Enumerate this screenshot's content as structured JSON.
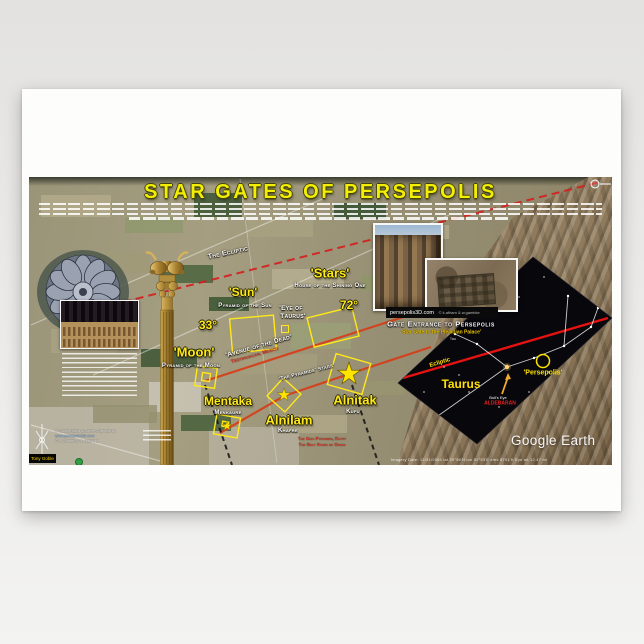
{
  "poster": {
    "title": "STAR GATES OF PERSEPOLIS"
  },
  "map": {
    "ecliptic_label": "The Ecliptic",
    "watermark": "Google Earth",
    "attribution": "Imagery Date: 12/31/2004      lat 29°56'N      lon 52°53'E      elev 5791 ft      Eye alt 12.47 mi",
    "sites": {
      "moon": {
        "angle": "33°",
        "name": "'Moon'",
        "sub": "Pyramid of the Moon"
      },
      "sun": {
        "name": "'Sun'",
        "sub": "Pyramid of the Sun"
      },
      "stars": {
        "angle": "72°",
        "name": "'Stars'",
        "sub": "House of the Shining One"
      },
      "eye_line1": "'Eye of",
      "eye_line2": "Taurus'",
      "avenue": "'Avenue of the Dead'",
      "avenue_sub": "Teotihuacan, Mexico",
      "alignment": "'The Pyramids' Stars'",
      "mentaka": {
        "name": "Mentaka",
        "sub": "Menkaure"
      },
      "alnilam": {
        "name": "Alnilam",
        "sub": "Khafre"
      },
      "alnitak": {
        "name": "Alnitak",
        "sub": "Kufu"
      },
      "giza_line1": "The Giza Pyramids, Egypt",
      "giza_line2": "The Belt Stars of Orion"
    },
    "insets": {
      "caption_site": "persepolis3D.com",
      "caption_credit": "© k.afham & w.gambke",
      "gate_title": "Gate Entrance to Persepolis",
      "gate_sub": "'Star Gate to the Pleiadian Palace'"
    },
    "star_chart": {
      "constellation": "Taurus",
      "ecliptic": "Ecliptic",
      "site": "'Persepolis'",
      "bulls_eye": "Bull's Eye",
      "star": "ALDEBARAN",
      "tau": "Tau"
    }
  },
  "credits": {
    "line1": "In Cooperation & Some Graphics by",
    "line2": "www.persepolis3D.com",
    "line3": "© K. Afham & W. Gambke",
    "badge": "Tony Goble"
  },
  "colors": {
    "accent_yellow": "#ffe81a",
    "alignment_red": "#d5401c",
    "ecliptic_red": "#d41f1f",
    "chart_black": "#07070c"
  }
}
